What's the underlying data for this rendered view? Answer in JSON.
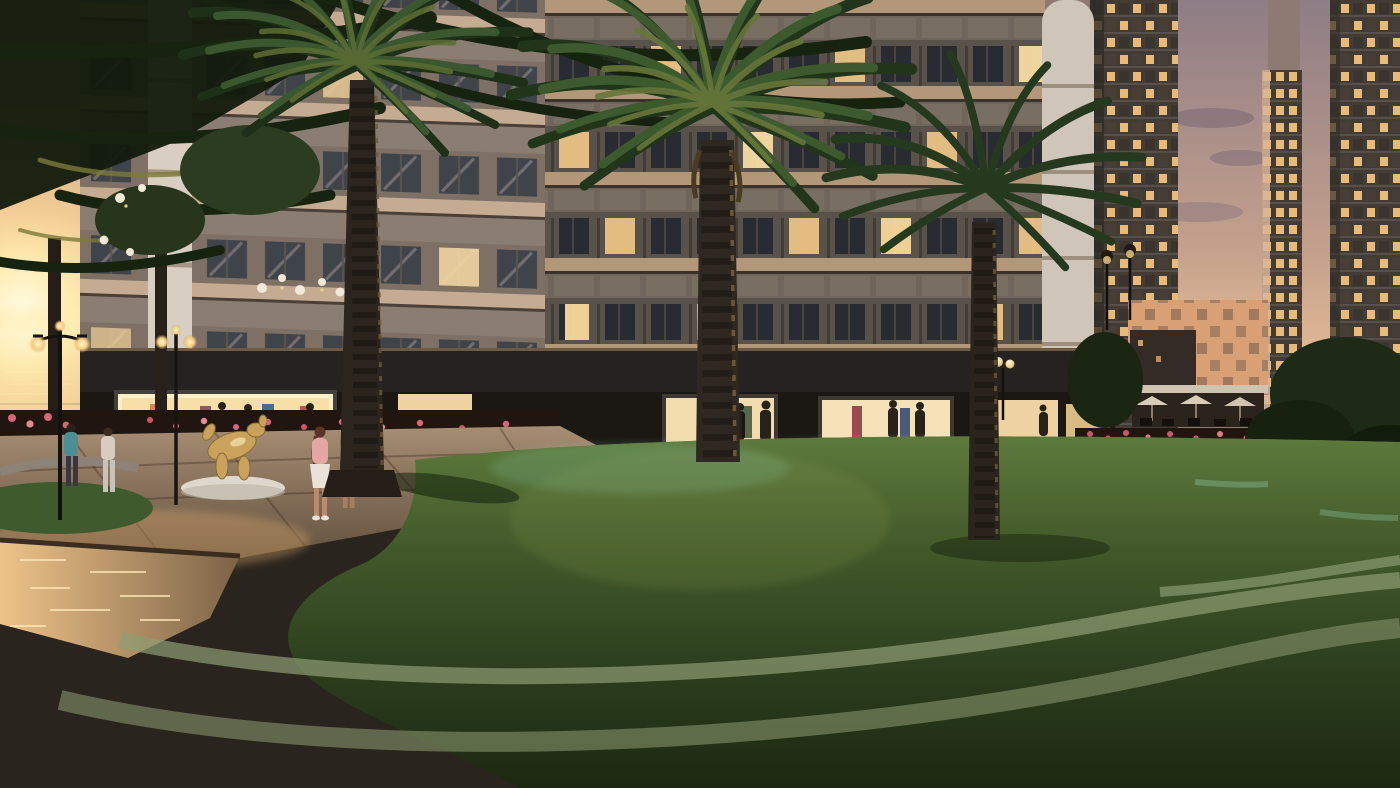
{
  "overlay": {
    "disclaimers": [
      "- Hình ảnh minh họa. Việc vận hành khu đô thị theo quy định của Ban Quản lý tại từng thời điểm.",
      "- Các hoạt động kinh doanh chỉ được thực hiện trong phạm vi ranh giới đất được sử dụng của Chủ sở hữu nhà/công trình và tuân thủ các quy định của Ban Quản lý tại từng thời điểm."
    ]
  },
  "scene": {
    "screen_content": "New York City skyline with Statue of Liberty",
    "colors": {
      "sun_glow": "#fff6d2",
      "sky_warm": "#f0cd9c",
      "sky_dusk": "#94838a",
      "building_wall": "#59524b",
      "floor_band": "#b29879",
      "window_lit": "#f2c987",
      "lawn_light": "#5a7638",
      "lawn_dark": "#1d2a13",
      "palm_dark": "#22371c",
      "beanbag": "#8d7e72",
      "accent_red": "#c0392f",
      "flower_orange": "#e07b28",
      "flower_pink": "#d8667a",
      "screen_frame": "#b5b2ad",
      "text": "#d5cfc6"
    }
  }
}
